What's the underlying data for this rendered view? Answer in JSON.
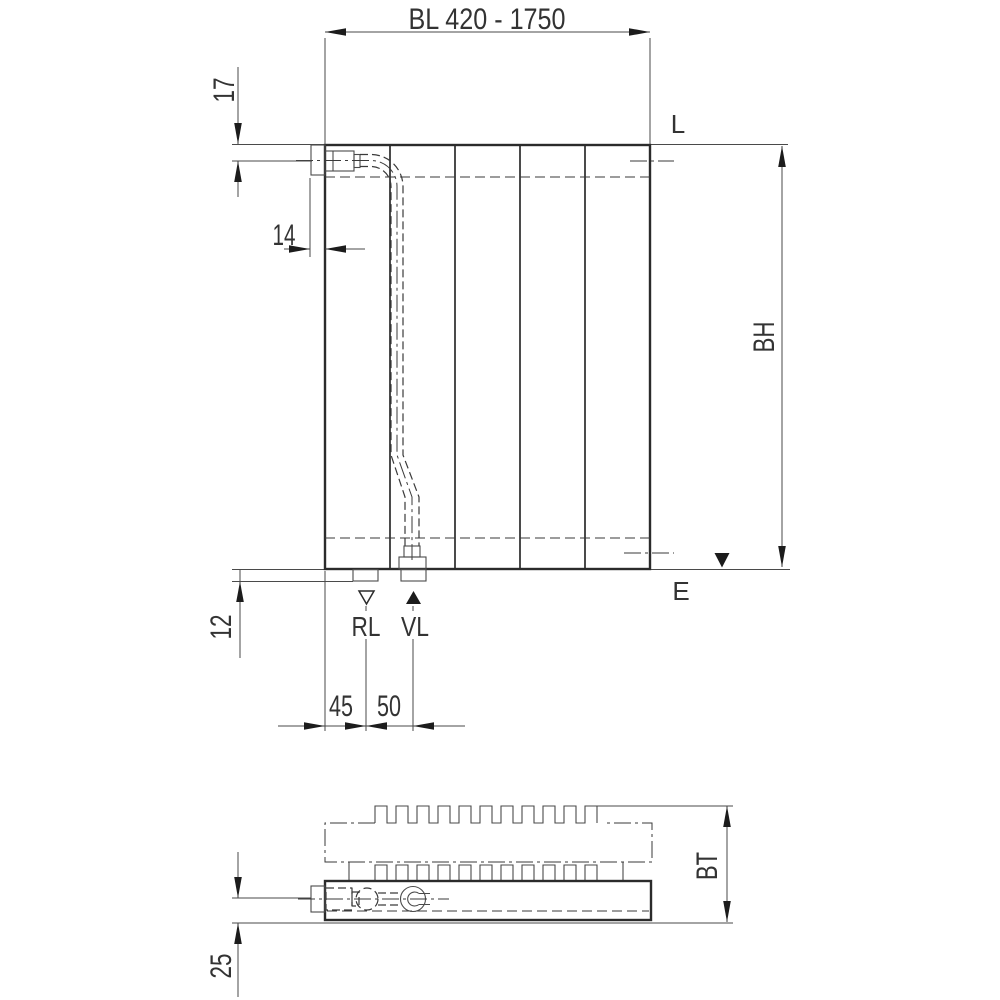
{
  "meta": {
    "drawing_type": "radiator dimension drawing, front view and plan view",
    "background_color": "#ffffff",
    "line_color": "#2b2b2b",
    "text_color": "#333333"
  },
  "front_view": {
    "width_label": "BL 420 - 1750",
    "dim_top_offset": "17",
    "dim_connector_protrusion": "14",
    "vent_label": "L",
    "height_label": "BH",
    "drain_label": "E",
    "dim_bottom_offset": "12",
    "return_label": "RL",
    "supply_label": "VL",
    "dim_return_spacing": "45",
    "dim_supply_spacing": "50"
  },
  "plan_view": {
    "depth_label": "BT",
    "dim_pipe_center_offset": "25"
  }
}
